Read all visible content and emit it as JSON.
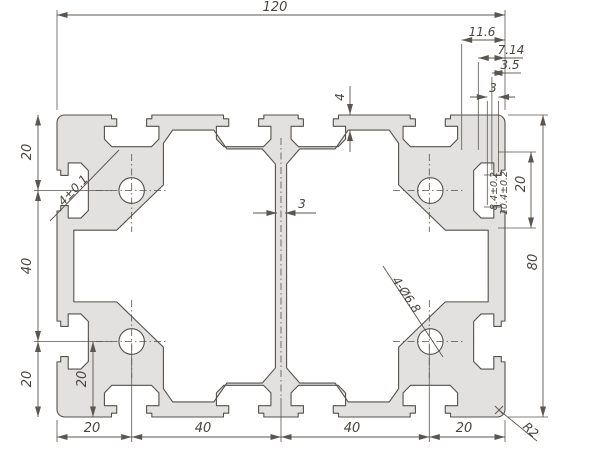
{
  "drawing": {
    "kind": "aluminium-extrusion-profile-cross-section",
    "colors": {
      "profile_fill": "#e2e1df",
      "outline": "#55504a",
      "dimension_lines": "#5b564f",
      "text": "#4a453f",
      "background": "#ffffff"
    },
    "dimensions": {
      "overall_width": "120",
      "overall_height": "80",
      "stack_1": "11.6",
      "stack_2": "7.14",
      "stack_3": "3.5",
      "stack_4": "3",
      "left_top": "20",
      "left_mid": "40",
      "left_bottom": "20",
      "inner_bottom_left": "20",
      "bottom_1": "20",
      "bottom_2": "40",
      "bottom_3": "40",
      "bottom_4": "20",
      "slot_cavity_width": "20",
      "slot_depth_1": "8.4±0.2",
      "slot_depth_2": "10.4±0.2",
      "slot_opening": "4±0.1",
      "web_thickness": "3",
      "wall_thickness": "4",
      "holes": "4-Ø6.8",
      "corner_radius": "R2"
    }
  }
}
